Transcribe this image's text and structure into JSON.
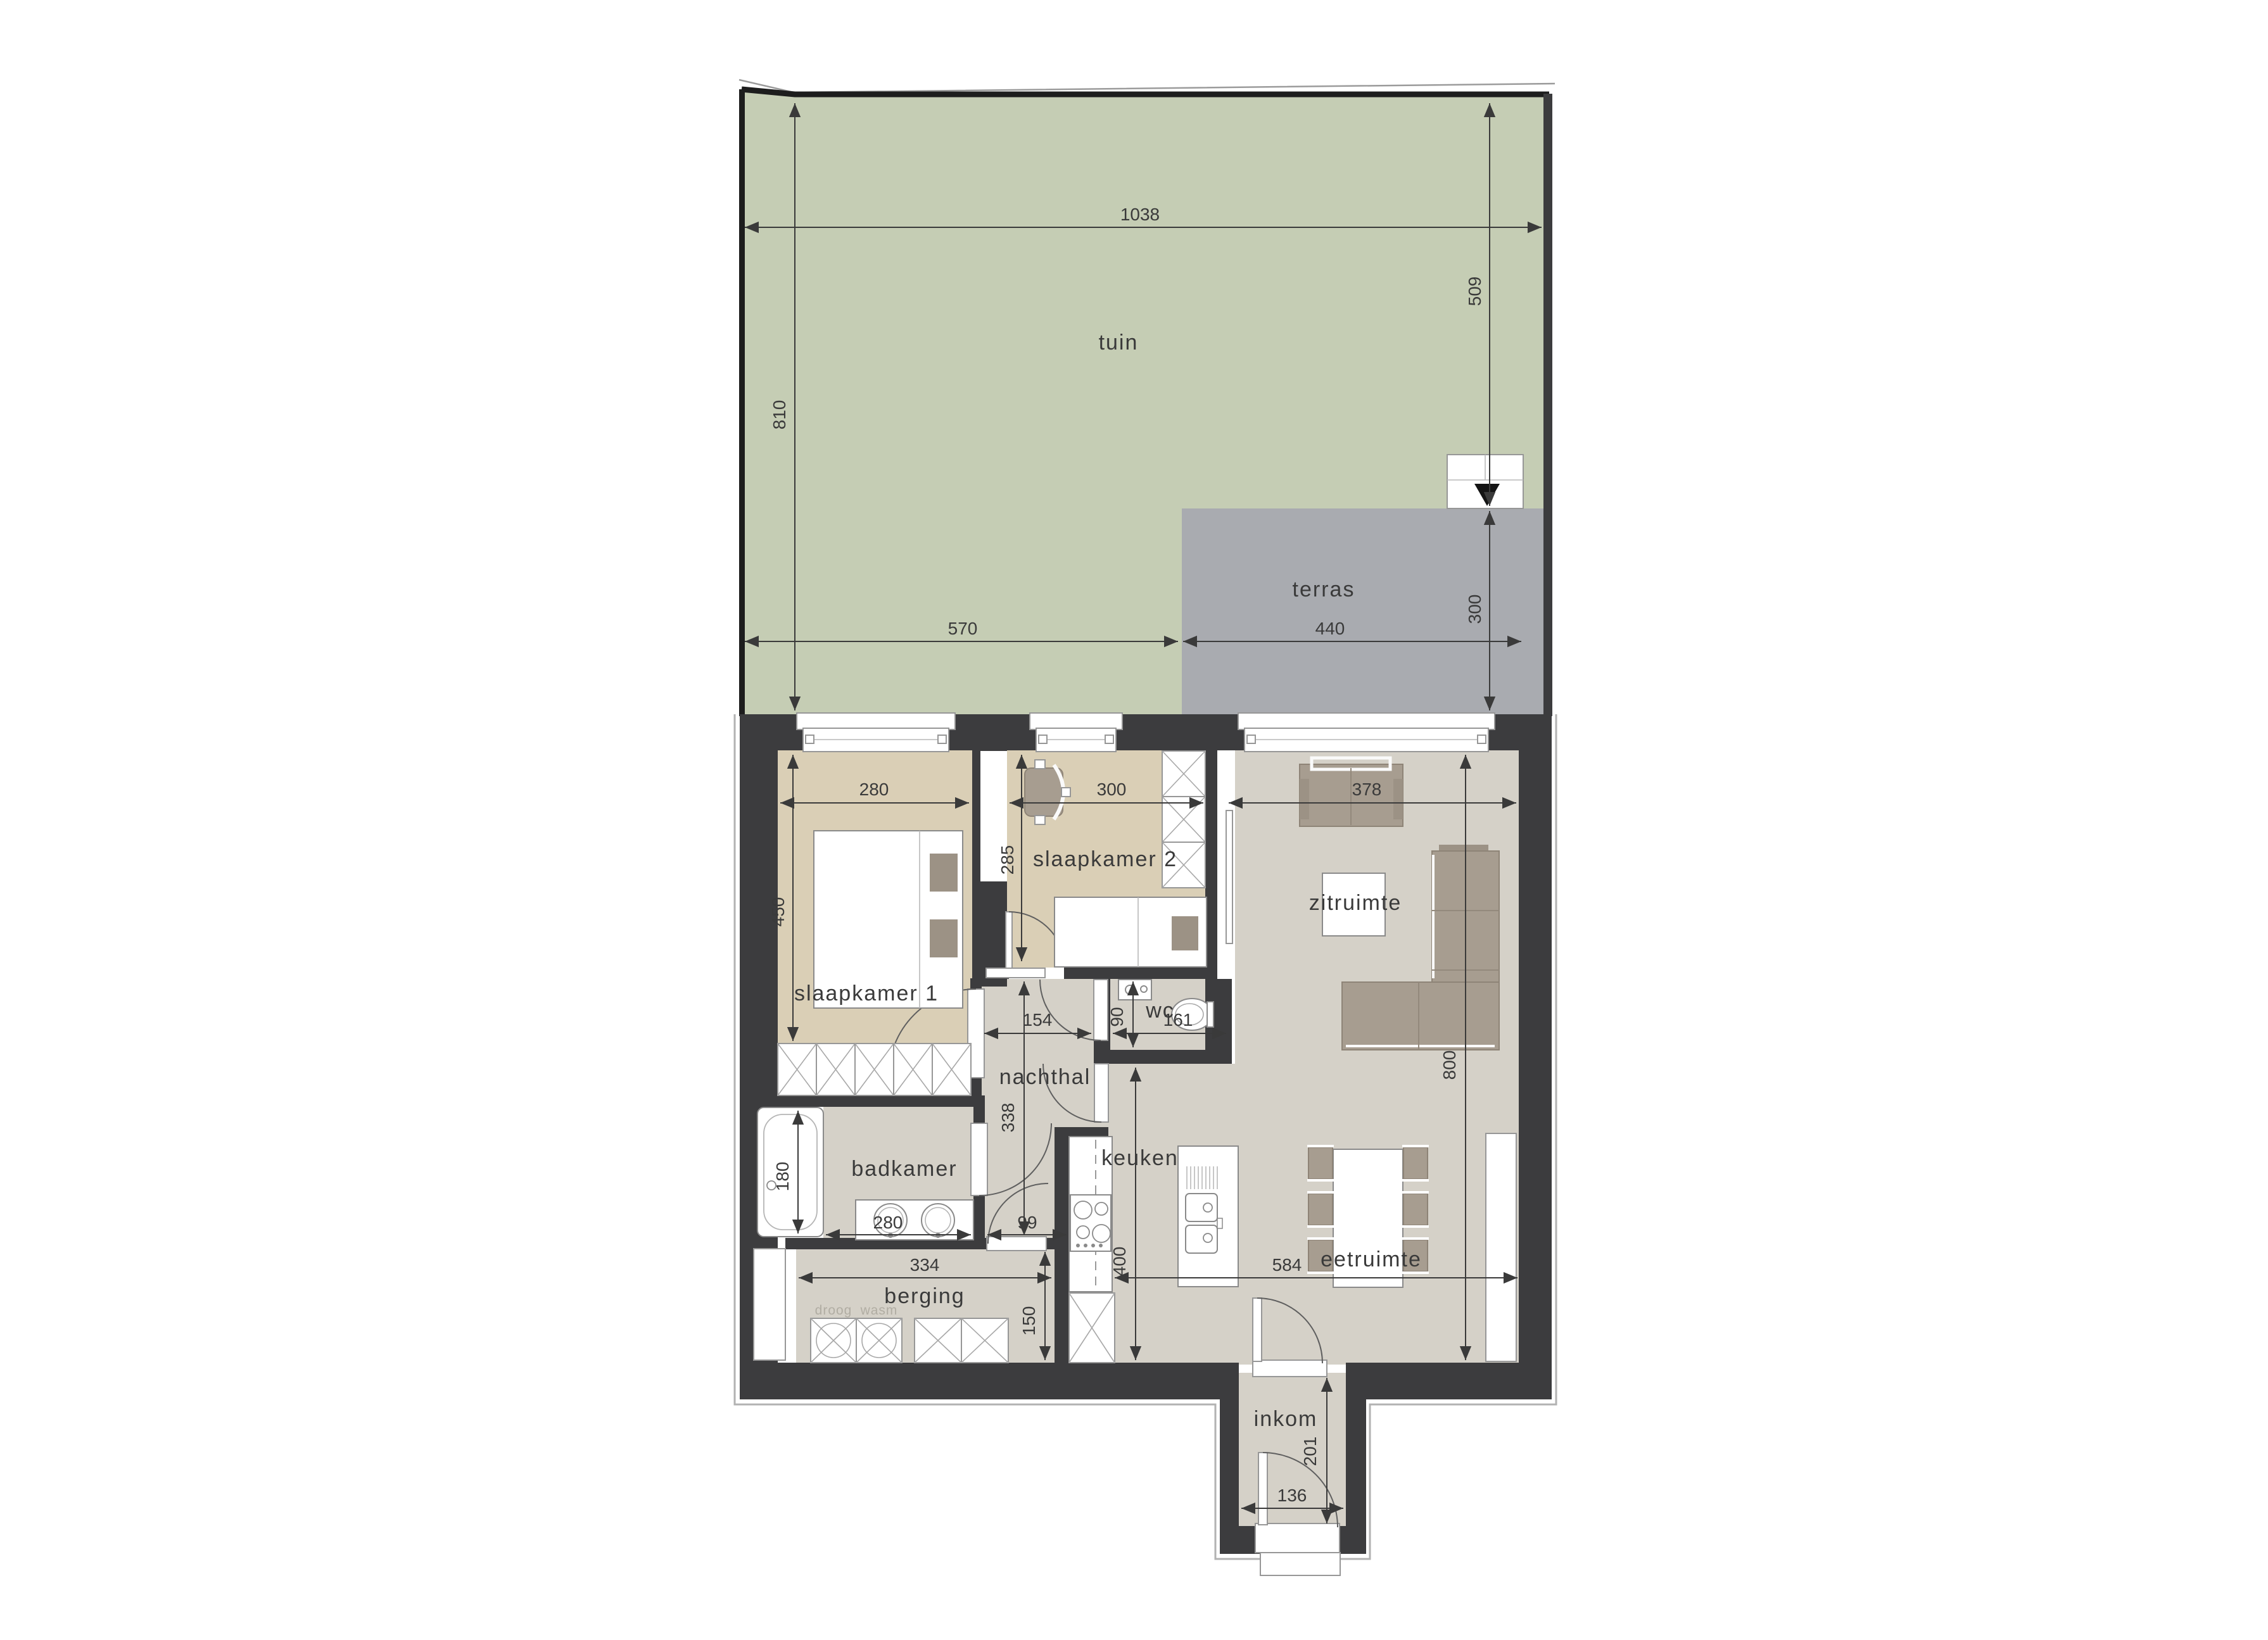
{
  "colors": {
    "garden": "#c5cdb4",
    "terrace": "#a9abb0",
    "wall": "#3c3c3e",
    "floor_warm": "#dacfb6",
    "floor_cool": "#d5d1c8",
    "furniture": "#a79d90",
    "line": "#3a3a3a"
  },
  "rooms": {
    "tuin": "tuin",
    "terras": "terras",
    "slaapkamer1": "slaapkamer 1",
    "slaapkamer2": "slaapkamer 2",
    "zitruimte": "zitruimte",
    "wc": "wc",
    "nachthal": "nachthal",
    "badkamer": "badkamer",
    "keuken": "keuken",
    "eetruimte": "eetruimte",
    "berging": "berging",
    "inkom": "inkom"
  },
  "appliances": {
    "droog": "droog",
    "wasm": "wasm"
  },
  "dimensions": {
    "garden_width": "1038",
    "garden_depth_left": "810",
    "garden_depth_right": "509",
    "garden_left_width": "570",
    "terrace_width": "440",
    "terrace_depth": "300",
    "bedroom1_width": "280",
    "bedroom1_depth": "450",
    "bedroom2_width": "300",
    "bedroom2_depth": "285",
    "living_width": "378",
    "living_depth": "800",
    "hall_width": "154",
    "wc_depth": "90",
    "wc_width": "161",
    "hall_length": "338",
    "bathtub_length": "180",
    "bath_width": "280",
    "passage_width": "99",
    "kitchen_depth": "400",
    "storage_width": "334",
    "storage_depth": "150",
    "dining_width": "584",
    "entry_width": "136",
    "entry_depth": "201"
  }
}
